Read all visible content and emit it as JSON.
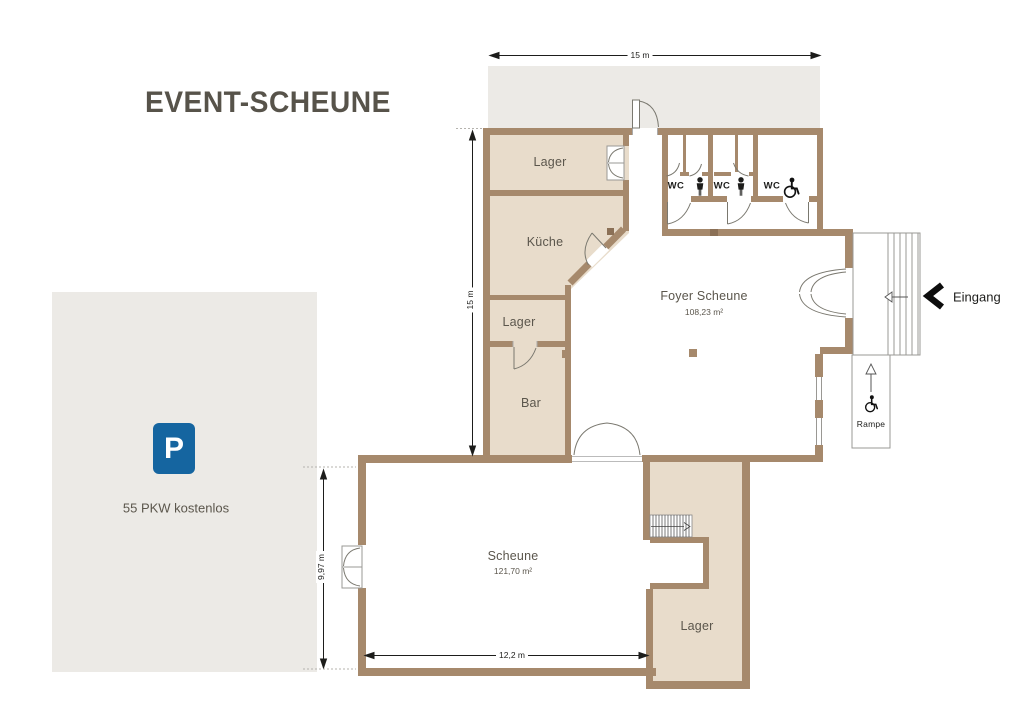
{
  "title": "EVENT-SCHEUNE",
  "colors": {
    "wall": "#A6896C",
    "wall_dark": "#8B7056",
    "room_fill": "#E8DCCB",
    "outdoor_fill": "#ECEAE6",
    "parking_blue": "#1565A0",
    "label_text": "#5B564C",
    "ink": "#1D1D1B"
  },
  "parking": {
    "sign": "P",
    "label": "55 PKW kostenlos"
  },
  "rooms": {
    "lager_top": {
      "label": "Lager"
    },
    "kueche": {
      "label": "Küche"
    },
    "lager_mid": {
      "label": "Lager"
    },
    "bar": {
      "label": "Bar"
    },
    "foyer": {
      "label": "Foyer Scheune",
      "area": "108,23 m²"
    },
    "scheune": {
      "label": "Scheune",
      "area": "121,70 m²"
    },
    "lager_bottom": {
      "label": "Lager"
    },
    "wc_left": {
      "label": "WC"
    },
    "wc_middle": {
      "label": "WC"
    },
    "wc_accessible": {
      "label": "WC"
    }
  },
  "annotations": {
    "eingang": "Eingang",
    "rampe": "Rampe"
  },
  "dimensions": {
    "top_width": "15 m",
    "left_height": "15 m",
    "scheune_height": "9,97 m",
    "scheune_width": "12,2 m"
  },
  "icons": {
    "parking_sign": "p-parking-icon",
    "wc_person": "person-icon",
    "wc_wheelchair": "wheelchair-icon",
    "entrance": "chevron-left-icon",
    "ramp_direction": "arrow-up-icon",
    "stairs_direction": "arrow-left-icon"
  }
}
